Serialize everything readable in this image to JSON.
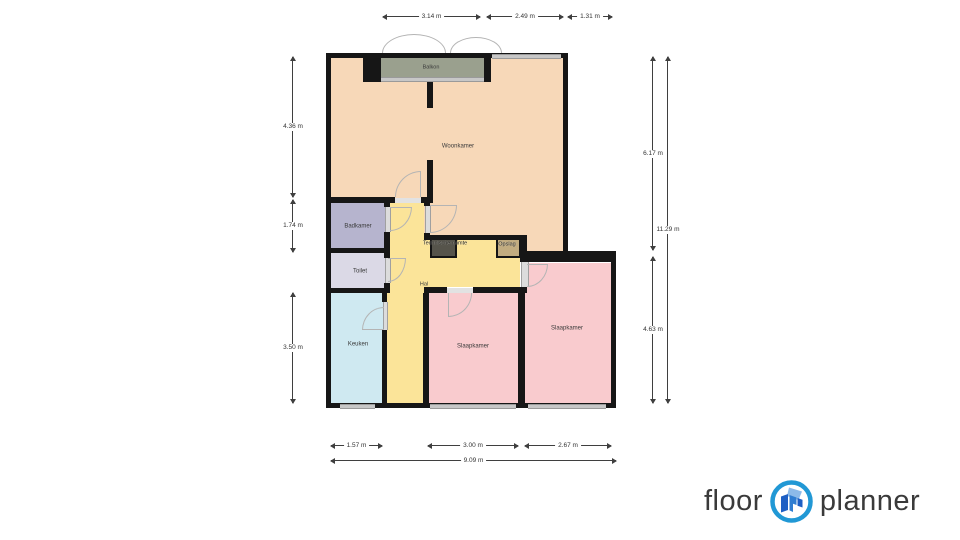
{
  "plan": {
    "rooms": {
      "balkon": "Balkon",
      "woonkamer": "Woonkamer",
      "badkamer": "Badkamer",
      "toilet": "Toilet",
      "keuken": "Keuken",
      "hal": "Hal",
      "technische_ruimte": "Technische ruimte",
      "opslag": "Opslag",
      "slaapkamer_1": "Slaapkamer",
      "slaapkamer_2": "Slaapkamer"
    },
    "colors": {
      "woonkamer": "#f7d8b8",
      "balkon": "#9aa08e",
      "badkamer": "#b6b4ce",
      "toilet": "#dbd9e6",
      "keuken": "#cfe9f1",
      "hal": "#fbe499",
      "slaapkamer": "#f9cbce",
      "technische_ruimte_box": "#56544b",
      "opslag_box": "#c2ac80",
      "wall": "#161616",
      "window": "#c7c7c7",
      "logo_ring": "#2198d5"
    }
  },
  "dimensions": {
    "top": [
      "3.14 m",
      "2.49 m",
      "1.31 m"
    ],
    "left": [
      "4.36 m",
      "1.74 m",
      "3.50 m"
    ],
    "right": [
      "6.17 m",
      "11.29 m",
      "4.63 m"
    ],
    "bottom": [
      "1.57 m",
      "3.00 m",
      "2.67 m",
      "9.09 m"
    ]
  },
  "logo": {
    "word1": "floor",
    "word2": "planner"
  }
}
